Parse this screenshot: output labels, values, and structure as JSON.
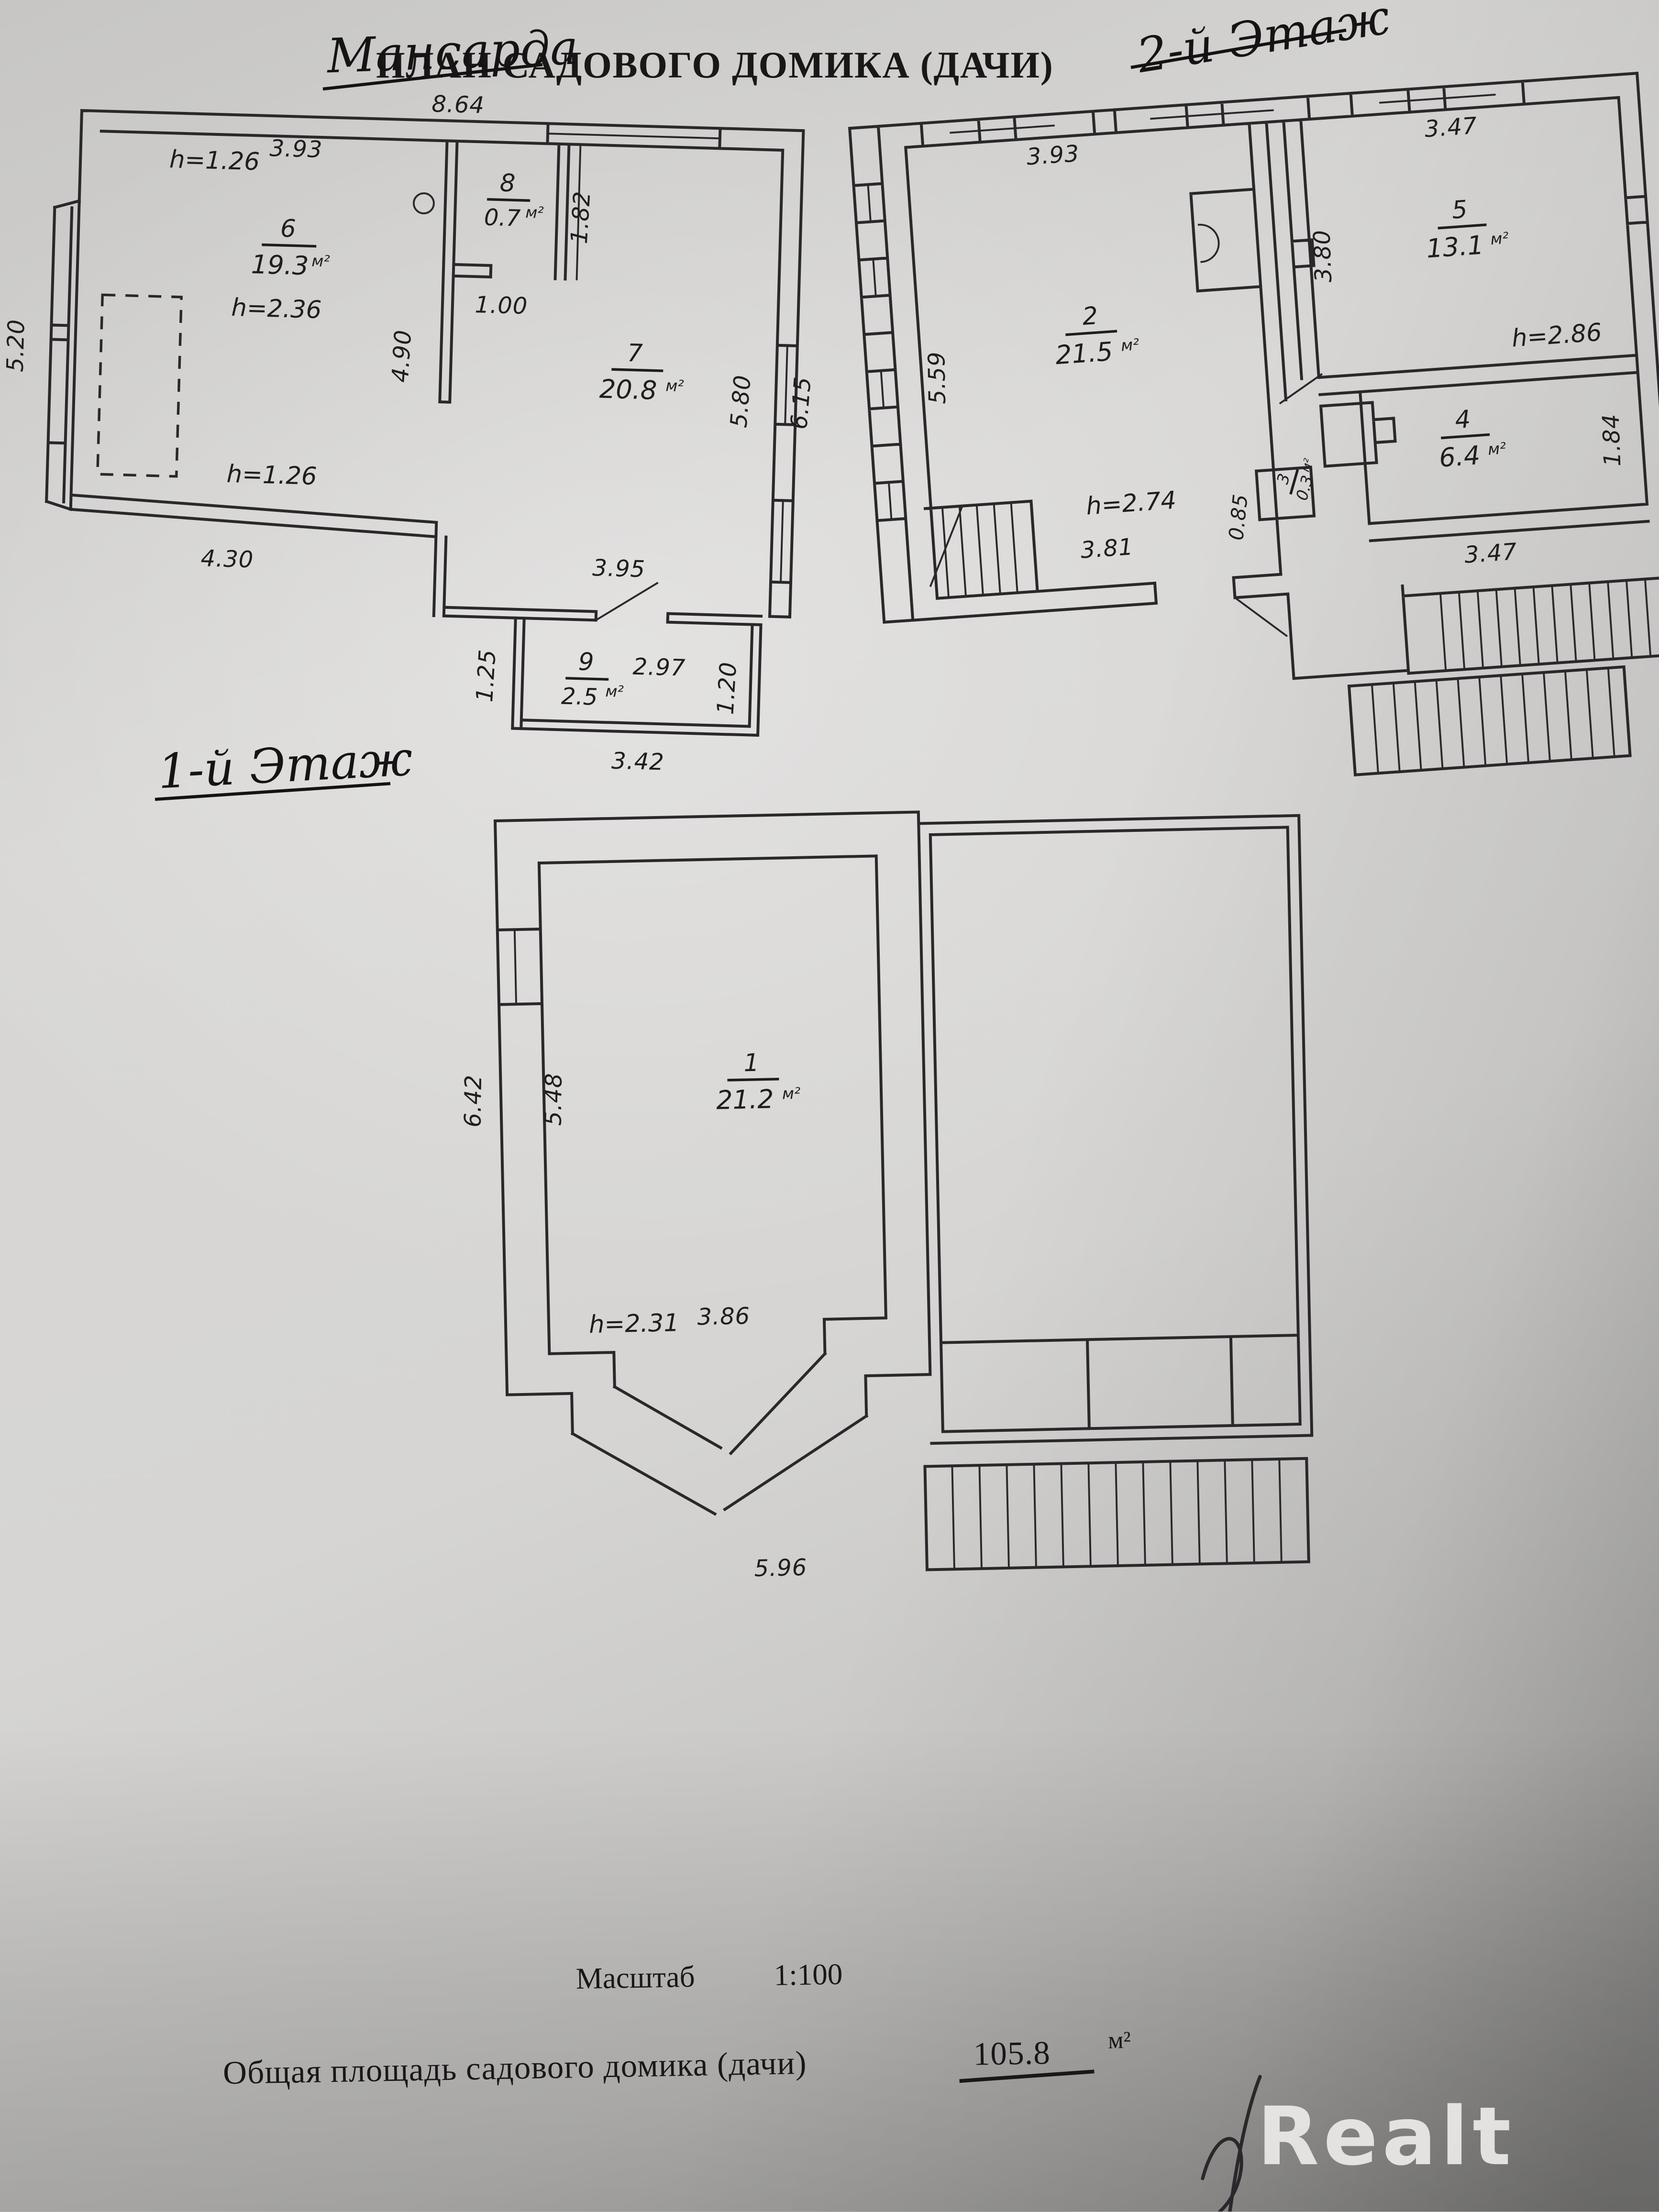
{
  "header": {
    "handwritten_title": "Мансарда",
    "printed_title": "План садового домика (дачи)",
    "floor2_label": "2-й Этаж"
  },
  "attic": {
    "h_top": "h=1.26",
    "dim_top_inner": "3.93",
    "dim_top_outer": "8.64",
    "dim_left": "5.20",
    "room6": {
      "number": "6",
      "area": "19.3",
      "unit": "м²"
    },
    "h_room6": "h=2.36",
    "room8": {
      "number": "8",
      "area": "0.7",
      "unit": "м²"
    },
    "dim_room8_door": "1.00",
    "dim_room8_height": "1.82",
    "room7": {
      "number": "7",
      "area": "20.8",
      "unit": "м²"
    },
    "dim_partition": "4.90",
    "dim_right_inner": "5.80",
    "dim_right_outer": "6.15",
    "h_bottom": "h=1.26",
    "dim_bottom_left": "4.30",
    "dim_room7_bottom": "3.95",
    "room9": {
      "number": "9",
      "area": "2.5",
      "unit": "м²"
    },
    "dim_room9_top": "2.97",
    "dim_room9_left": "1.25",
    "dim_room9_right": "1.20",
    "dim_room9_bottom": "3.42"
  },
  "floor2": {
    "dim_top_left": "3.93",
    "dim_left": "5.59",
    "room2": {
      "number": "2",
      "area": "21.5",
      "unit": "м²"
    },
    "room3": {
      "number": "3",
      "area": "0.3",
      "unit": "м²"
    },
    "dim_room3_left": "0.85",
    "dim_top_right": "3.47",
    "room5": {
      "number": "5",
      "area": "13.1",
      "unit": "м²"
    },
    "dim_room5_left": "3.80",
    "h_room5": "h=2.86",
    "room4": {
      "number": "4",
      "area": "6.4",
      "unit": "м²"
    },
    "dim_room4_right": "1.84",
    "dim_room4_bottom": "3.47",
    "h_room2": "h=2.74",
    "dim_room2_bottom": "3.81"
  },
  "floor1": {
    "label": "1-й Этаж",
    "dim_left_outer": "6.42",
    "dim_left_inner": "5.48",
    "room1": {
      "number": "1",
      "area": "21.2",
      "unit": "м²"
    },
    "h_room1": "h=2.31",
    "dim_bottom_inner": "3.86",
    "dim_bottom_outer": "5.96"
  },
  "footer": {
    "scale_word": "Масштаб",
    "scale_value": "1:100",
    "total_label": "Общая площадь садового домика (дачи)",
    "total_value": "105.8",
    "total_unit": "м²"
  },
  "watermark": "Realt"
}
